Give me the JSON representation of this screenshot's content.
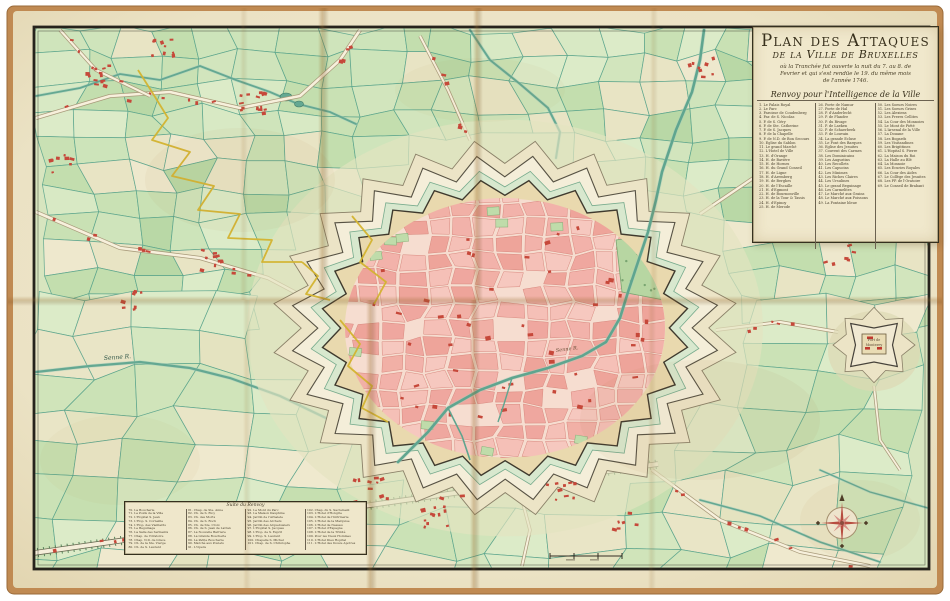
{
  "cartouche": {
    "title_line1": "Plan des Attaques",
    "title_line2": "de la Ville de Bruxelles",
    "subtitle_lines": [
      "où la Tranchée fut ouverte la nuit du 7. au 8. de",
      "Fevrier et qui s'est rendüe le 19. du même mois",
      "de l'année 1746."
    ],
    "legend_header": "Renvoy pour l'Intelligence de la Ville",
    "columns": [
      {
        "entries": [
          "1. Le Palais Royal",
          "2. Le Parc",
          "3. Paroisse de Coudenberg",
          "4. Par. de S. Nicolas",
          "5. P. de S. Géry",
          "6. P. de Ste. Catherine",
          "7. P. de S. Jacques",
          "8. P. de la Chapelle",
          "9. P. de N.D. de Bon Secours",
          "10. Eglise du Sablon",
          "11. Le grand Marché",
          "12. L'Hotel de Ville",
          "13. H. d'Orange",
          "14. H. de Bavière",
          "15. H. de Hornes",
          "16. H. du Grand Conseil",
          "17. H. de Ligne",
          "18. H. d'Aremberg",
          "19. H. de Berghes",
          "20. H. de l'Escaille",
          "21. H. d'Egmont",
          "22. H. de Bournonville",
          "23. H. de la Tour & Tassis",
          "24. H. d'Epinoy",
          "25. H. de Merode"
        ]
      },
      {
        "entries": [
          "26. Porte de Namur",
          "27. Porte de Hal",
          "28. P. d'Anderlecht",
          "29. P. de Flandre",
          "30. P. du Rivage",
          "31. P. de Laeken",
          "32. P. de Schaerbeek",
          "33. P. de Louvain",
          "34. La grande Ecluse",
          "35. Le Pont des Barques",
          "36. Eglise des Jesuites",
          "37. Couvent des Carmes",
          "38. Les Dominicains",
          "39. Les Augustins",
          "40. Les Recollets",
          "41. Les Capucins",
          "42. Les Minimes",
          "43. Les Riches Claires",
          "44. Les Ursulines",
          "45. Le grand Beguinage",
          "46. Les Carmelites",
          "47. Le Marché aux Grains",
          "48. Le Marché aux Poissons",
          "49. La Fontaine bleue"
        ]
      },
      {
        "entries": [
          "50. Les Soeurs Noires",
          "51. Les Soeurs Grises",
          "52. Les Alexiens",
          "53. Les Freres Cellites",
          "54. La Cour des Monnoies",
          "55. Le Mont de Piété",
          "56. L'Arsenal de la Ville",
          "57. La Douane",
          "58. Les Bogards",
          "59. Les Visitandines",
          "60. Les Brigittines",
          "61. L'Hopital S. Pierre",
          "62. La Maison du Roi",
          "63. La Halle au Blé",
          "64. La Monnoie",
          "65. Les Ecuries Royales",
          "66. La Cour des Aides",
          "67. Le Collège des Jesuites",
          "68. Les PP. de l'Oratoire",
          "69. Le Conseil de Brabant"
        ]
      }
    ]
  },
  "bottom_legend": {
    "header": "Suite du Renvoy",
    "columns": [
      [
        "70. La Boucherie",
        "71. Le Poids de la Ville",
        "72. L'Hopital S. Jean",
        "73. L'Hop. S. Corneille",
        "74. L'Hop. des Vieillards",
        "75. Le Beguinage",
        "76. La Salle des Serments",
        "77. Chap. de l'Oratoire",
        "78. Chap. N.D. de Grace",
        "79. Ch. de la Ste. Vierge",
        "80. Ch. de S. Laurent"
      ],
      [
        "81. Chap. de Ste. Anne",
        "82. Ch. de S. Eloy",
        "83. Ch. des Morts",
        "84. Ch. de S. Roch",
        "85. Ch. de Ste. Croix",
        "86. Ch. de S. Jean de Latran",
        "87. La Nouvelle Barriere",
        "88. La Grande Boucherie",
        "89. La Petite Boucherie",
        "90. Marché aux Poulets",
        "91. L'Opera"
      ],
      [
        "92. Le Mont du Parc",
        "93. La Maison Dauphine",
        "94. Jardin de l'Arbalete",
        "95. Jardin des Archers",
        "96. Jardin des Arquebusiers",
        "97. L'Hopital S. Jacques",
        "98. L'Hop. de S. Esprit",
        "99. L'Hop. S. Laurent",
        "100. Chapelle S. Michel",
        "101. Chap. de S. Christophe"
      ],
      [
        "102. Chap. du S. Sacrement",
        "103. L'Hotel d'Hongrie",
        "104. L'Hotel de l'Infirmerie",
        "105. L'Hotel de la Marquise",
        "106. L'Hotel de Nassau",
        "107. L'Hotel d'Espagne",
        "108. L'Hotel de la Trinité",
        "109. Pour les Vieux Hommes",
        "110. L'Hotel Dieu Hopital",
        "111. L'Hotel des Douze Apotres"
      ]
    ]
  },
  "labels": {
    "river_west": "Senne R.",
    "river_city": "Senne R.",
    "fort_line1": "Fort de",
    "fort_line2": "Monterey"
  },
  "colors": {
    "parchment": "#ece3c6",
    "backing": "#c08a52",
    "field_green": "#cfe3ba",
    "field_stroke": "#55a189",
    "city_pink": "#f2b2aa",
    "accent_red": "#c6483a",
    "water": "#64a892",
    "trench_yellow": "#d3b32f",
    "rampart": "#e9d9ae",
    "frame": "#26231c"
  }
}
